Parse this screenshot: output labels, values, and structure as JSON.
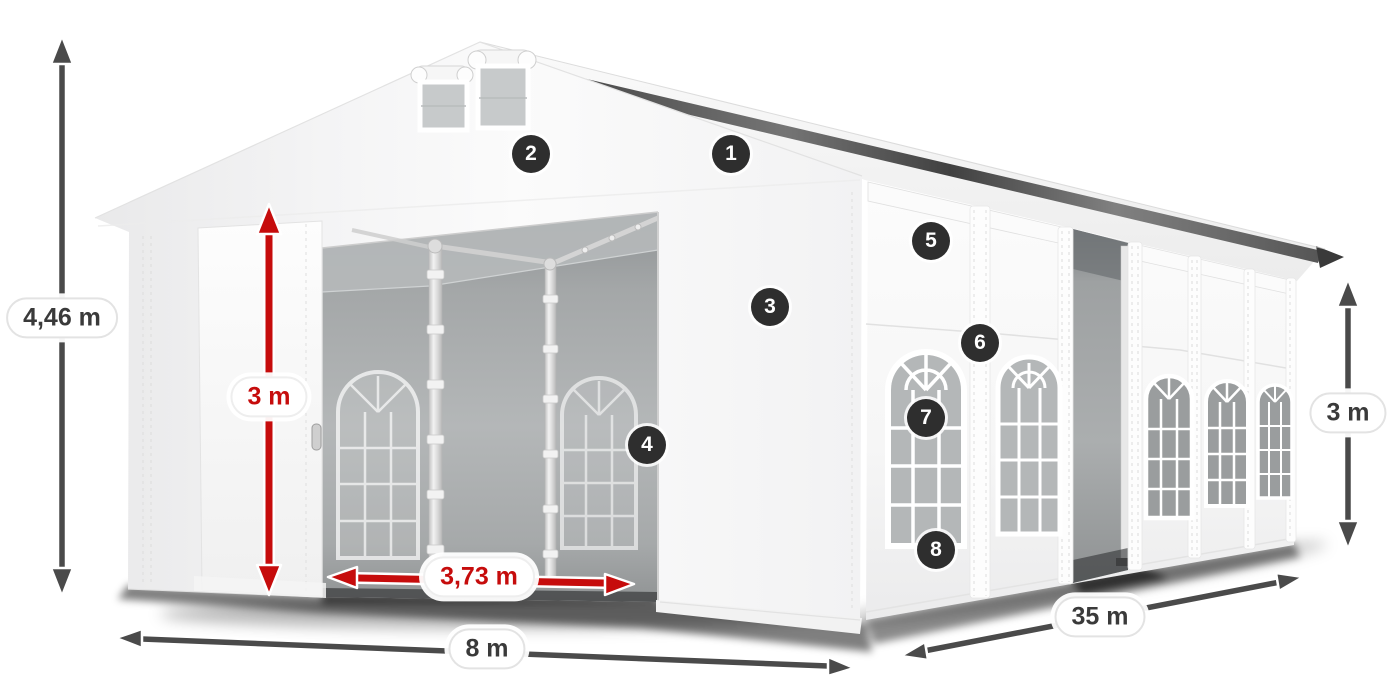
{
  "diagram": {
    "subject": "marquee-tent-dimensions",
    "measurements": {
      "total_height": {
        "value": "4,46 m"
      },
      "entrance_height": {
        "value": "3 m"
      },
      "entrance_width": {
        "value": "3,73 m"
      },
      "width": {
        "value": "8 m"
      },
      "length": {
        "value": "35 m"
      },
      "side_height": {
        "value": "3 m"
      }
    },
    "callouts": [
      {
        "number": "1"
      },
      {
        "number": "2"
      },
      {
        "number": "3"
      },
      {
        "number": "4"
      },
      {
        "number": "5"
      },
      {
        "number": "6"
      },
      {
        "number": "7"
      },
      {
        "number": "8"
      }
    ],
    "colors": {
      "dimension_red": "#c60c0c",
      "dimension_dark": "#4a4a4a",
      "badge_background": "#2e2e2e",
      "badge_text": "#ffffff",
      "pill_background": "#ffffff",
      "pill_border": "#e3e3e3",
      "label_text": "#3a3a3a"
    }
  }
}
